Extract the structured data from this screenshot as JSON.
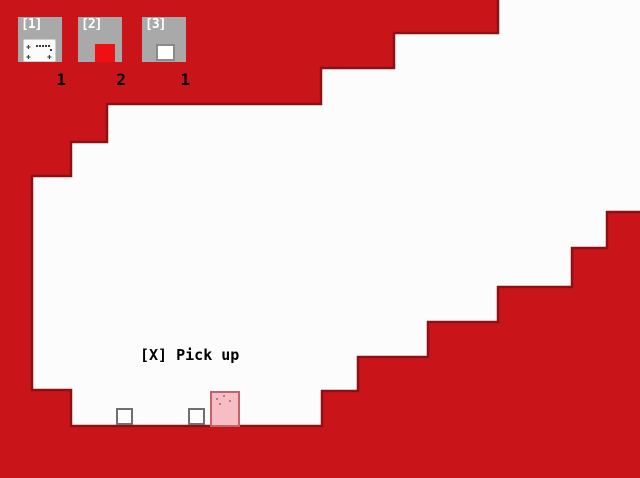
{
  "theme": {
    "wall_red": "#c9141a",
    "wall_outline_dark": "#8c1014",
    "room_white": "#fcfcfc",
    "slot_gray": "#a9a9a9",
    "slot_key_color": "#ffffff",
    "count_color": "#000000",
    "icon_plate_white": "#fbfbfb",
    "icon_dot_color": "#3a3a3a",
    "icon_red_block": "#ee1013",
    "icon_box_border": "#8a8a8a",
    "icon_box_white": "#ffffff",
    "item_white": "#fdfdfd",
    "item_border_gray": "#6f6f6f",
    "player_pink": "#f6bdc4",
    "player_border": "#c2636b",
    "player_dot_color": "#9a6a70",
    "prompt_color": "#000000"
  },
  "hud": {
    "slots": [
      {
        "key_label": "[1]",
        "count": "1",
        "icon": "dotted-plate-icon"
      },
      {
        "key_label": "[2]",
        "count": "2",
        "icon": "red-block-icon"
      },
      {
        "key_label": "[3]",
        "count": "1",
        "icon": "white-box-icon"
      }
    ]
  },
  "prompt": {
    "text": "[X] Pick up"
  },
  "entities": {
    "player": "pink-slab-player",
    "ground_items": [
      "small-white-box",
      "small-white-box"
    ]
  },
  "level": {
    "room_outline_points": "498,-5 645,-5 645,212 607,212 607,248 572,248 572,287 498,287 498,322 428,322 428,357 358,357 358,391 322,391 322,426 71,426 71,390 32,390 32,176 71,176 71,142 107,142 107,104 321,104 321,68 394,68 394,33 498,33"
  }
}
